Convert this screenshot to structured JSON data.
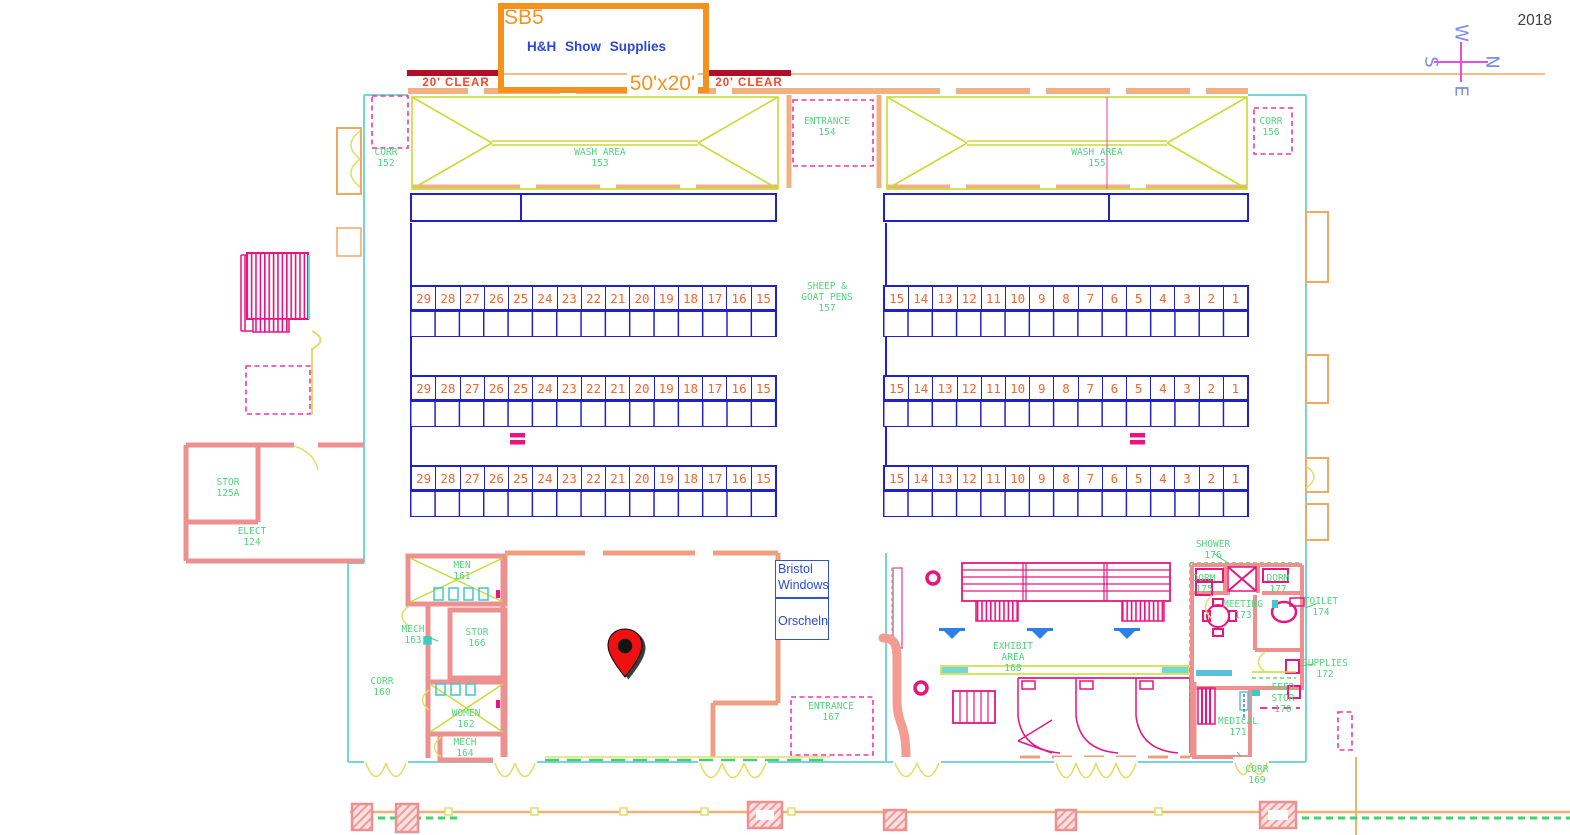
{
  "year": "2018",
  "compass": {
    "n": "N",
    "e": "E",
    "s": "S",
    "w": "W"
  },
  "booth": {
    "id": "SB5",
    "vendor": "H&H Show Supplies",
    "size": "50'x20'",
    "clear_left": "20' CLEAR",
    "clear_right": "20' CLEAR"
  },
  "vendors": {
    "bristol_line1": "Bristol",
    "bristol_line2": "Windows",
    "orscheln": "Orscheln"
  },
  "rooms": {
    "corr152": {
      "l1": "CORR",
      "l2": "152"
    },
    "wash153": {
      "l1": "WASH AREA",
      "l2": "153"
    },
    "entrance154": {
      "l1": "ENTRANCE",
      "l2": "154"
    },
    "wash155": {
      "l1": "WASH AREA",
      "l2": "155"
    },
    "corr156": {
      "l1": "CORR",
      "l2": "156"
    },
    "pens157": {
      "l1": "SHEEP &",
      "l2": "GOAT PENS",
      "l3": "157"
    },
    "stor125a": {
      "l1": "STOR",
      "l2": "125A"
    },
    "elect124": {
      "l1": "ELECT",
      "l2": "124"
    },
    "men161": {
      "l1": "MEN",
      "l2": "161"
    },
    "mech163": {
      "l1": "MECH",
      "l2": "163"
    },
    "stor166": {
      "l1": "STOR",
      "l2": "166"
    },
    "corr160": {
      "l1": "CORR",
      "l2": "160"
    },
    "women162": {
      "l1": "WOMEN",
      "l2": "162"
    },
    "mech164": {
      "l1": "MECH",
      "l2": "164"
    },
    "entrance167": {
      "l1": "ENTRANCE",
      "l2": "167"
    },
    "exhibit168": {
      "l1": "EXHIBIT",
      "l2": "AREA",
      "l3": "168"
    },
    "shower176": {
      "l1": "SHOWER",
      "l2": "176"
    },
    "dorm175": {
      "l1": "DORM",
      "l2": "175"
    },
    "dorm177": {
      "l1": "DORM",
      "l2": "177"
    },
    "meeting173": {
      "l1": "MEETING",
      "l2": "173"
    },
    "toilet174": {
      "l1": "TOILET",
      "l2": "174"
    },
    "supplies172": {
      "l1": "SUPPLIES",
      "l2": "172"
    },
    "feed170": {
      "l1": "FEED",
      "l2": "STOR",
      "l3": "170"
    },
    "medical171": {
      "l1": "MEDICAL",
      "l2": "171"
    },
    "corr169": {
      "l1": "CORR",
      "l2": "169"
    }
  },
  "pens": {
    "left_numbers": [
      "29",
      "28",
      "27",
      "26",
      "25",
      "24",
      "23",
      "22",
      "21",
      "20",
      "19",
      "18",
      "17",
      "16",
      "15"
    ],
    "right_numbers": [
      "15",
      "14",
      "13",
      "12",
      "11",
      "10",
      "9",
      "8",
      "7",
      "6",
      "5",
      "4",
      "3",
      "2",
      "1"
    ]
  },
  "colors": {
    "pen_line_blue": "#2121cc",
    "pen_number_orange": "#f4662d",
    "room_label_green": "#50d57c",
    "booth_orange": "#f5921e",
    "clearance_red": "#b00d28",
    "vendor_blue": "#2b48d8",
    "structure_magenta": "#ea1480",
    "wall_salmon": "#ef9090",
    "wall_cyan": "#74d6d6",
    "wash_green": "#c8dc2f",
    "pin_red": "#ee1111"
  }
}
